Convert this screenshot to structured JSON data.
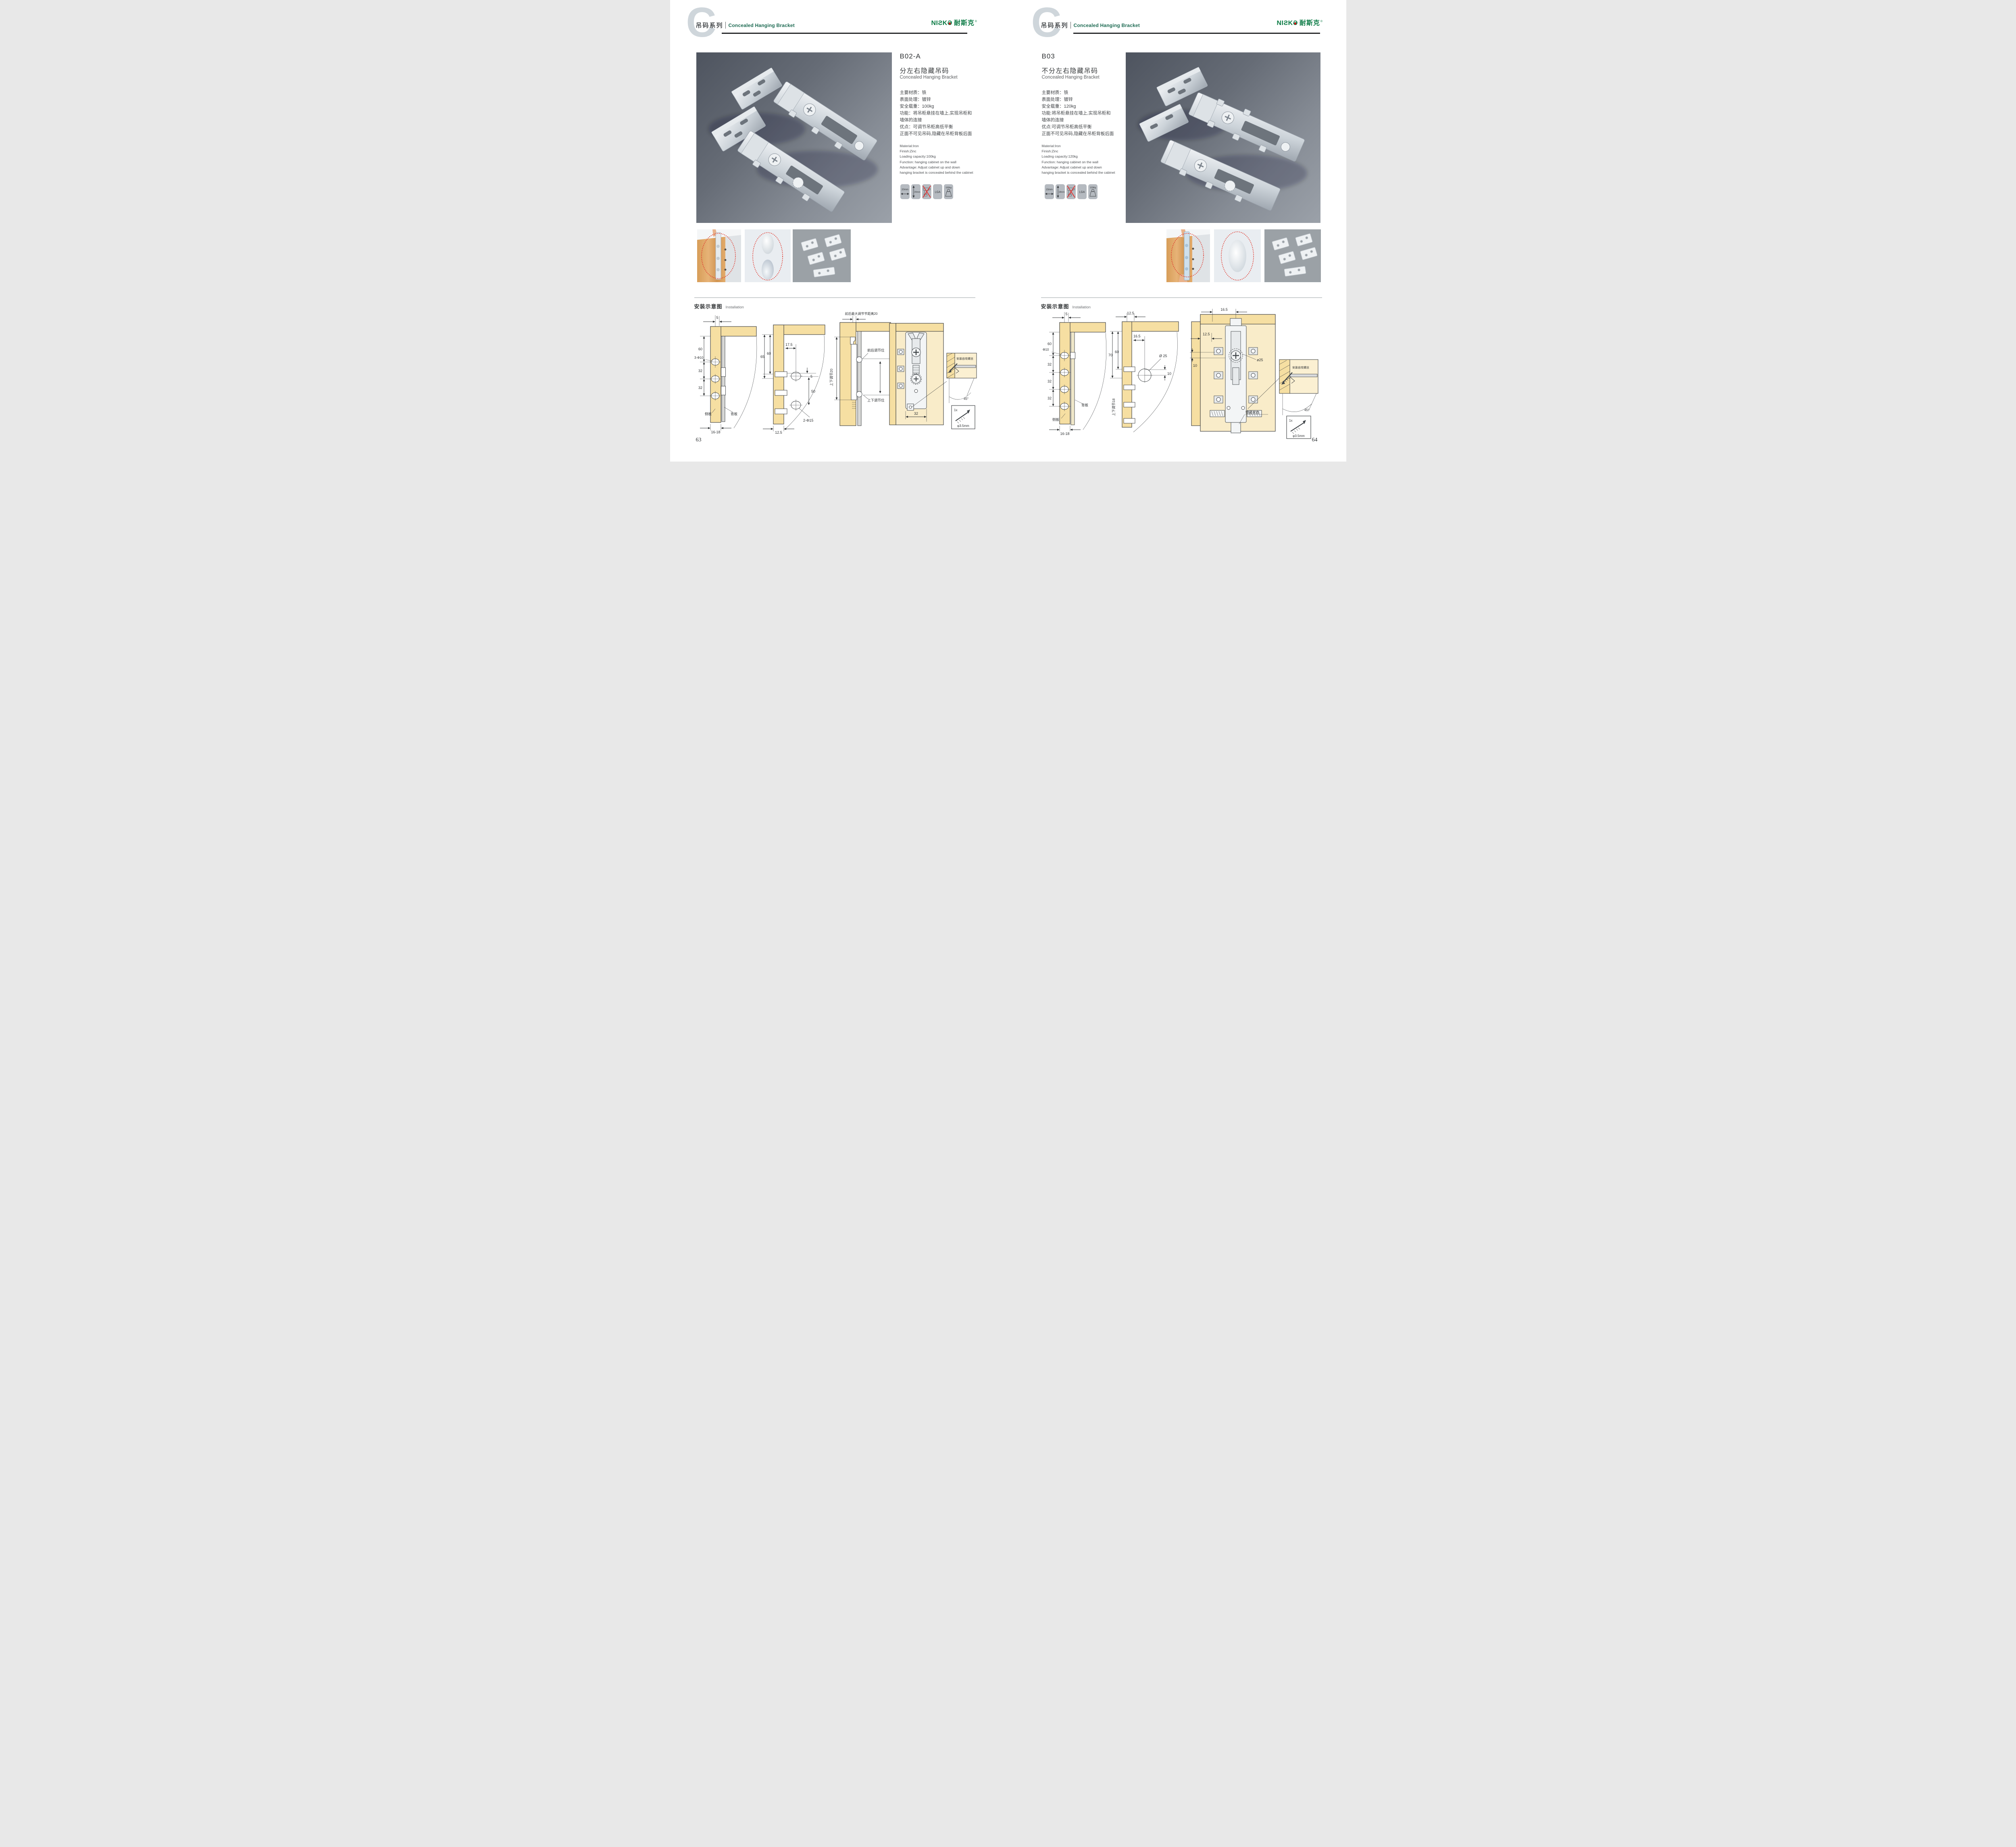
{
  "brand": {
    "logo_en": "NIƧK",
    "logo_o": "Ə",
    "logo_cn": "耐斯克",
    "reg": "®",
    "watermark": "C"
  },
  "header": {
    "series_cn": "吊码系列",
    "series_en": "Concealed Hanging Bracket"
  },
  "left": {
    "page_number": "63",
    "product": {
      "code": "B02-A",
      "name_cn": "分左右隐藏吊码",
      "name_en": "Concealed Hanging Bracket",
      "specs_cn": [
        "主要材质：铁",
        "表面处理：镀锌",
        "安全载重：100kg",
        "功能：将吊柜悬挂在墙上,实现吊柜和",
        "墙体的连接",
        "优点：可调节吊柜高低平衡",
        "正面不可见吊码,隐藏在吊柜背板后面"
      ],
      "specs_en": [
        "Material:Iron",
        "Finish:Zinc",
        "Loading capacity:100kg",
        "Function: hanging cabinet on the wall",
        "Advantage: Adjust cabinet up and down",
        "hanging bracket is concealed behind the cabinet"
      ],
      "icons": {
        "i1": "20mm",
        "i2": "20mm",
        "i4": "LGA",
        "i5": "100kg"
      }
    },
    "installation": {
      "title_cn": "安装示意图",
      "title_en": "Installation",
      "d1": {
        "dim5": "5",
        "dim60": "60",
        "hole": "3-Φ10",
        "dim32a": "32",
        "dim32b": "32",
        "side": "侧板",
        "back": "背板",
        "bottom": "16-18"
      },
      "d2": {
        "dim65": "65",
        "dim60": "60",
        "dim175": "17.5",
        "dim5": "5",
        "dim50": "50",
        "hole": "2-Φ15",
        "bottom": "12.5"
      },
      "d3": {
        "top": "前后最大调节节距离20",
        "vert": "上下调节20",
        "fb": "前后调节位",
        "ud": "上下调节位"
      },
      "d4": {
        "dim32": "32",
        "screw": "安装自攻螺丝",
        "angle": "45°",
        "qty": "1x",
        "dia": "φ3.5mm"
      }
    }
  },
  "right": {
    "page_number": "64",
    "product": {
      "code": "B03",
      "name_cn": "不分左右隐藏吊码",
      "name_en": "Concealed Hanging Bracket",
      "specs_cn": [
        "主要材质：铁",
        "表面处理：镀锌",
        "安全载重：120kg",
        "功能:将吊柜悬挂在墙上,实现吊柜和",
        "墙体的连接",
        "优点:可调节吊柜高低平衡",
        "正面不可见吊码,隐藏在吊柜背板后面"
      ],
      "specs_en": [
        "Material:Iron",
        "Finish:Zinc",
        "Loading capacity:120kg",
        "Function: hanging cabinet on the wall",
        "Advantage: Adjust cabinet up and down",
        "hanging bracket is concealed behind the cabinet"
      ],
      "icons": {
        "i1": "15mm",
        "i2": "18mm",
        "i4": "LGA",
        "i5": "120Kg"
      }
    },
    "installation": {
      "title_cn": "安装示意图",
      "title_en": "Installation",
      "d5": {
        "dim5": "5",
        "dim60": "60",
        "hole": "Φ10",
        "dim32a": "32",
        "dim32b": "32",
        "dim32c": "32",
        "side": "侧板",
        "back": "背板",
        "bottom": "16-18"
      },
      "d6": {
        "dim125": "12.5",
        "dim165": "16.5",
        "dim70": "70",
        "dim60": "60",
        "hole": "Ø 25",
        "dim10": "10",
        "vert": "上下调节18"
      },
      "d7": {
        "dim165": "16.5",
        "dim125": "12.5",
        "dim10": "10",
        "hole": "ø25",
        "lock": "锁紧状态",
        "screw": "安装自攻螺丝",
        "angle": "45°",
        "qty": "1x",
        "dia": "φ3.5mm"
      }
    }
  },
  "colors": {
    "accent_green": "#1d6a52",
    "logo_green": "#0b7b45",
    "logo_red": "#e60012",
    "panel_tan": "#f6dfa2",
    "dash_red": "#e0392e"
  }
}
